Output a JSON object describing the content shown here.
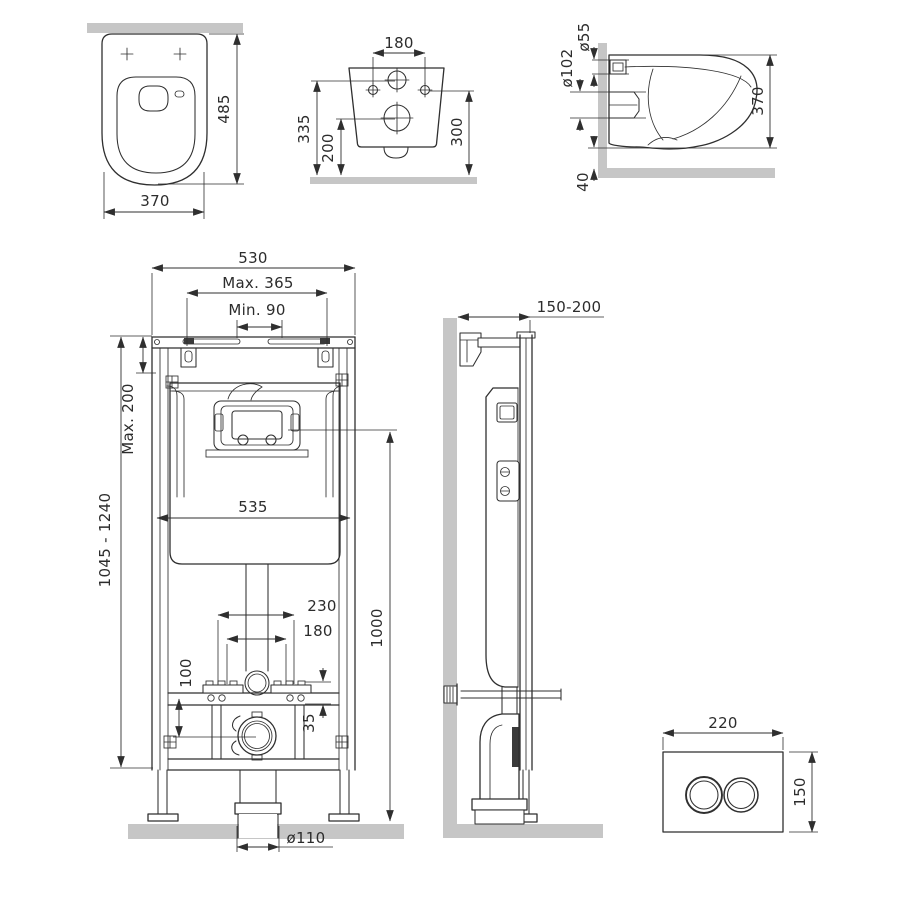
{
  "drawing": {
    "colors": {
      "line": "#2f2f2f",
      "wall_floor_gray": "#c6c6c6",
      "background": "#ffffff"
    },
    "views": {
      "toilet_top": {
        "dim_height": "485",
        "dim_width": "370"
      },
      "toilet_rear": {
        "dim_hole_spacing": "180",
        "dim_height_left": "335",
        "dim_drain_height": "200",
        "dim_height_right": "300"
      },
      "toilet_side": {
        "dim_inlet_diameter": "ø55",
        "dim_outlet_diameter": "ø102",
        "dim_height": "370",
        "dim_floor_gap": "40"
      },
      "frame_front": {
        "dim_frame_width": "530",
        "dim_max_span": "Max. 365",
        "dim_min_span": "Min. 90",
        "dim_max_top": "Max. 200",
        "dim_height_range": "1045 - 1240",
        "dim_cistern_width": "535",
        "dim_span_230": "230",
        "dim_span_180": "180",
        "dim_offset_100": "100",
        "dim_offset_35": "35",
        "dim_height_1000": "1000",
        "dim_drain_diameter": "ø110"
      },
      "frame_side": {
        "dim_depth_range": "150-200"
      },
      "flush_plate": {
        "dim_width": "220",
        "dim_height": "150"
      }
    }
  }
}
